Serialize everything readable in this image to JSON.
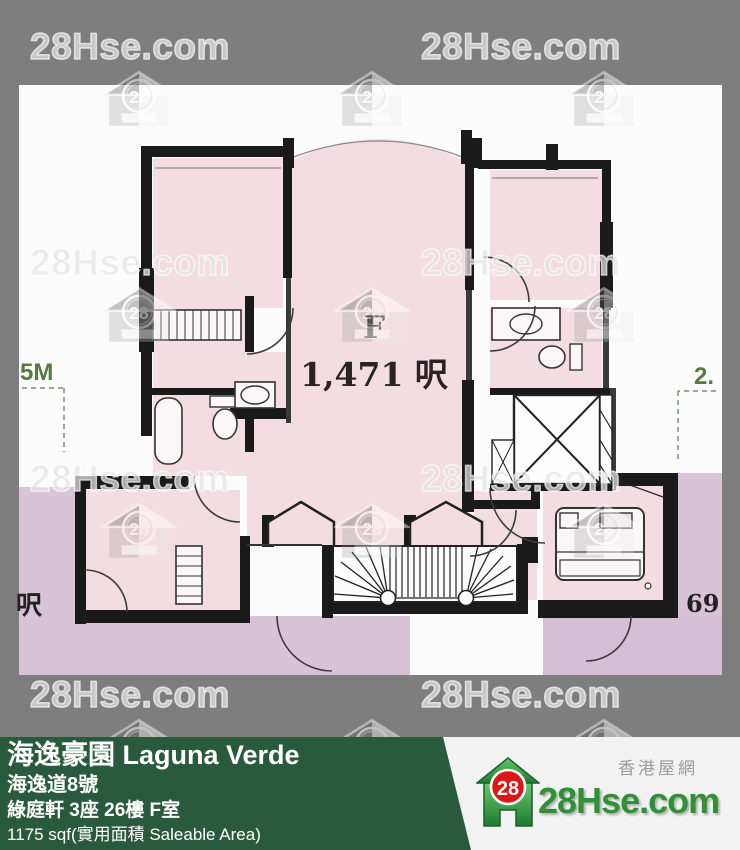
{
  "watermark": {
    "text": "28Hse.com",
    "badge": "28"
  },
  "plan": {
    "unit_label": "F",
    "area_label": "1,471 呎",
    "dim_left": "5M",
    "dim_left_bottom": "呎",
    "dim_right": "2.",
    "dim_right_bottom": "69"
  },
  "footer": {
    "title": "海逸豪園 Laguna Verde",
    "address": "海逸道8號",
    "unit": "綠庭軒 3座 26樓 F室",
    "area": "1175 sqf(實用面積 Saleable Area)"
  },
  "logo": {
    "badge": "28",
    "site": "28Hse.com",
    "tagline": "香港屋網"
  },
  "colors": {
    "background_gray": "#7e7e7e",
    "room_pink": "#f3dde2",
    "neighbor_purple": "#d9c3d6",
    "wall_black": "#1a1a1a",
    "footer_green": "#2a5a3e",
    "logo_red": "#e01515",
    "logo_green": "#2f9135",
    "dimension_green": "#567a42"
  }
}
